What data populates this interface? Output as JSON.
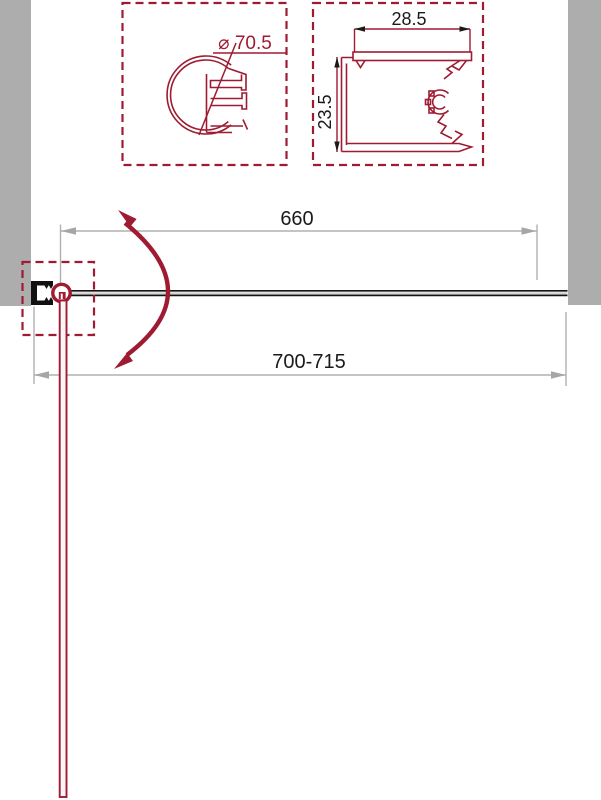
{
  "details": {
    "hinge_profile": {
      "diameter_label": "⌀ 70.5"
    },
    "wall_profile": {
      "width_label": "28.5",
      "height_label": "23.5"
    }
  },
  "plan": {
    "glass_width_label": "660",
    "overall_width_label": "700-715"
  },
  "colors": {
    "accent_red": "#9E1B32",
    "wall_gray": "#ADADAD",
    "dimension_gray": "#B0B0B0",
    "text_black": "#1A1A1A"
  }
}
